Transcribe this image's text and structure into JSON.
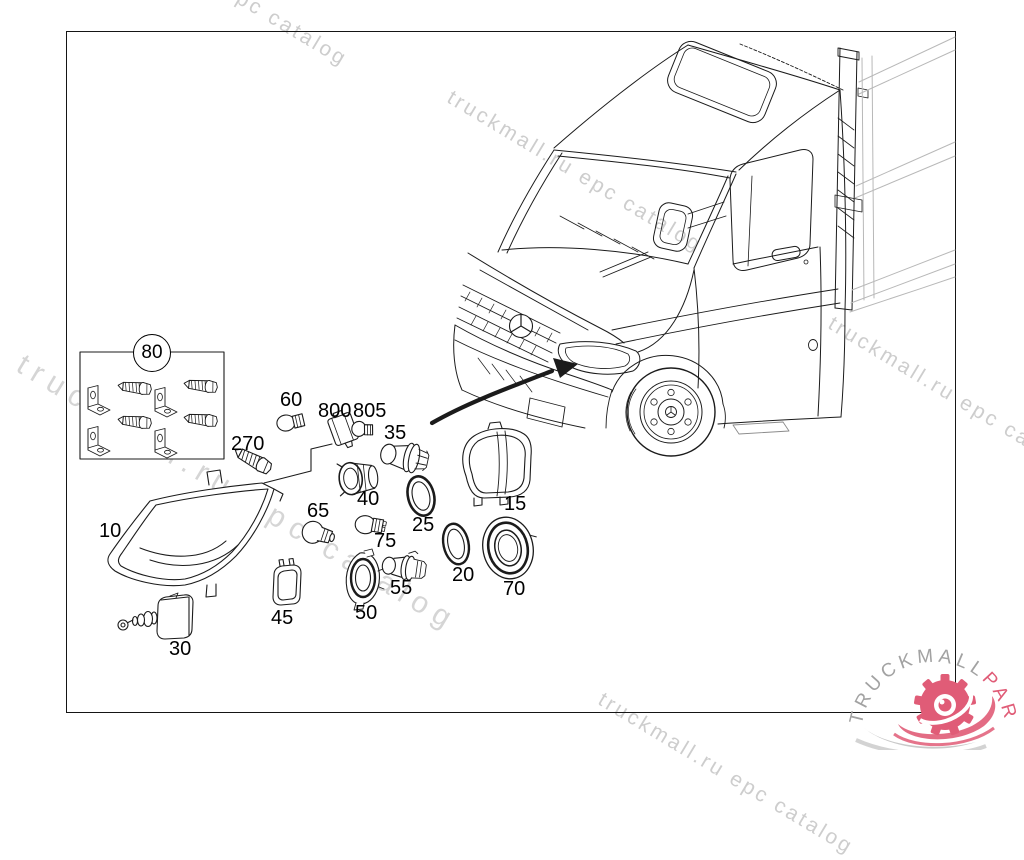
{
  "watermark": {
    "text": "truckmall.ru epc catalog",
    "color": "#c8c8c8"
  },
  "logo": {
    "brand_gray": "TRUCKMALL",
    "brand_red": "PARTS",
    "gray_color": "#a2a2a2",
    "red_color": "#e05c77"
  },
  "callouts": [
    {
      "id": "mounting-kit",
      "number": "80"
    },
    {
      "id": "headlamp-unit",
      "number": "10"
    },
    {
      "id": "bolt",
      "number": "270"
    },
    {
      "id": "bulb-small",
      "number": "60"
    },
    {
      "id": "bulb-socket",
      "number": "800"
    },
    {
      "id": "bulb-wedge",
      "number": "805"
    },
    {
      "id": "bulb-h7-upper",
      "number": "35"
    },
    {
      "id": "socket-bayonet",
      "number": "40"
    },
    {
      "id": "bulb-p21w",
      "number": "65"
    },
    {
      "id": "sealing-ring-upper",
      "number": "25"
    },
    {
      "id": "bulb-wedge-2",
      "number": "75"
    },
    {
      "id": "protective-cover",
      "number": "15"
    },
    {
      "id": "sealing-ring-lower",
      "number": "20"
    },
    {
      "id": "sealing-cap",
      "number": "70"
    },
    {
      "id": "bulb-h7-lower",
      "number": "55"
    },
    {
      "id": "retainer-ring",
      "number": "50"
    },
    {
      "id": "control-module",
      "number": "45"
    },
    {
      "id": "levelling-motor",
      "number": "30"
    }
  ]
}
